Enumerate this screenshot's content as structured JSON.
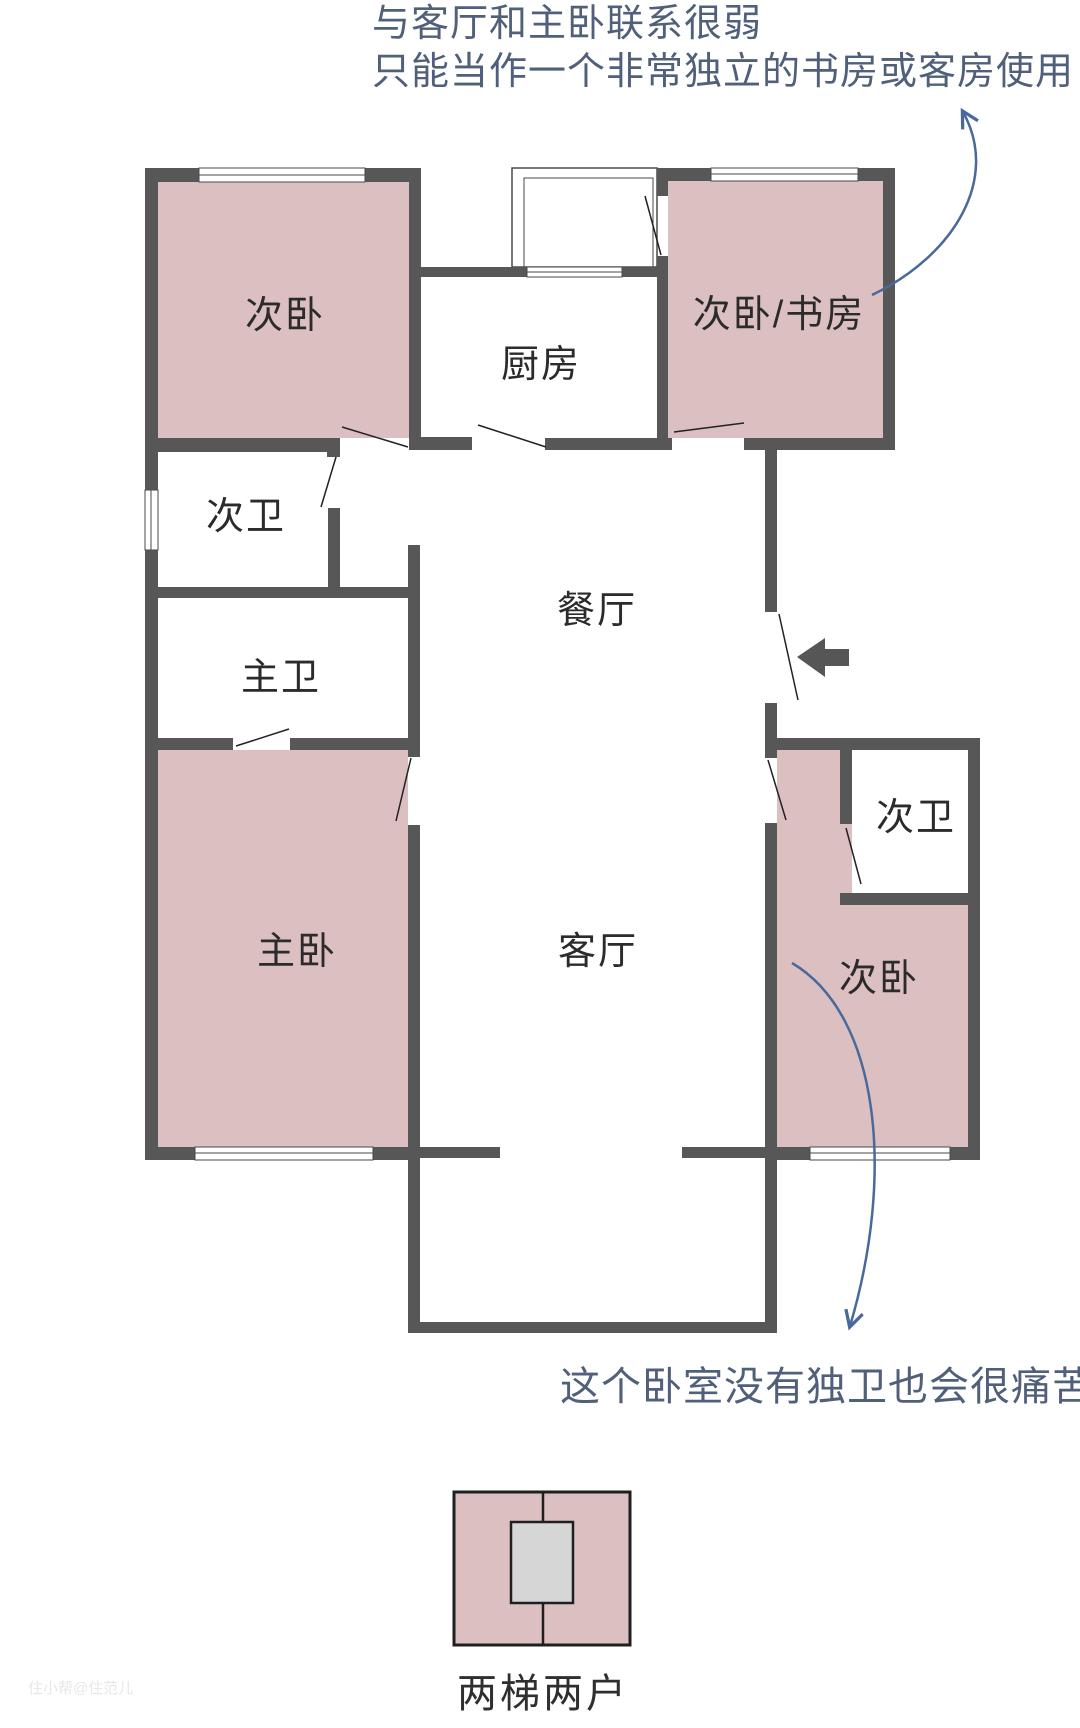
{
  "annotations": {
    "top_note_line1": "与客厅和主卧联系很弱",
    "top_note_line2": "只能当作一个非常独立的书房或客房使用",
    "bottom_note": "这个卧室没有独卫也会很痛苦"
  },
  "rooms": {
    "bedroom_top_left": "次卧",
    "kitchen": "厨房",
    "bedroom_study": "次卧/书房",
    "bath_secondary_left": "次卫",
    "bath_master": "主卫",
    "dining_room": "餐厅",
    "master_bedroom": "主卧",
    "living_room": "客厅",
    "bath_secondary_right": "次卫",
    "bedroom_right": "次卧"
  },
  "legend": {
    "core_label": "两梯两户"
  },
  "watermark": "住小帮@住范儿",
  "colors": {
    "wall": "#575757",
    "room_fill": "#dcc0c1",
    "core_fill": "#d6d6d6",
    "annotation_text": "#50607a",
    "annotation_arrow": "#49699a"
  }
}
